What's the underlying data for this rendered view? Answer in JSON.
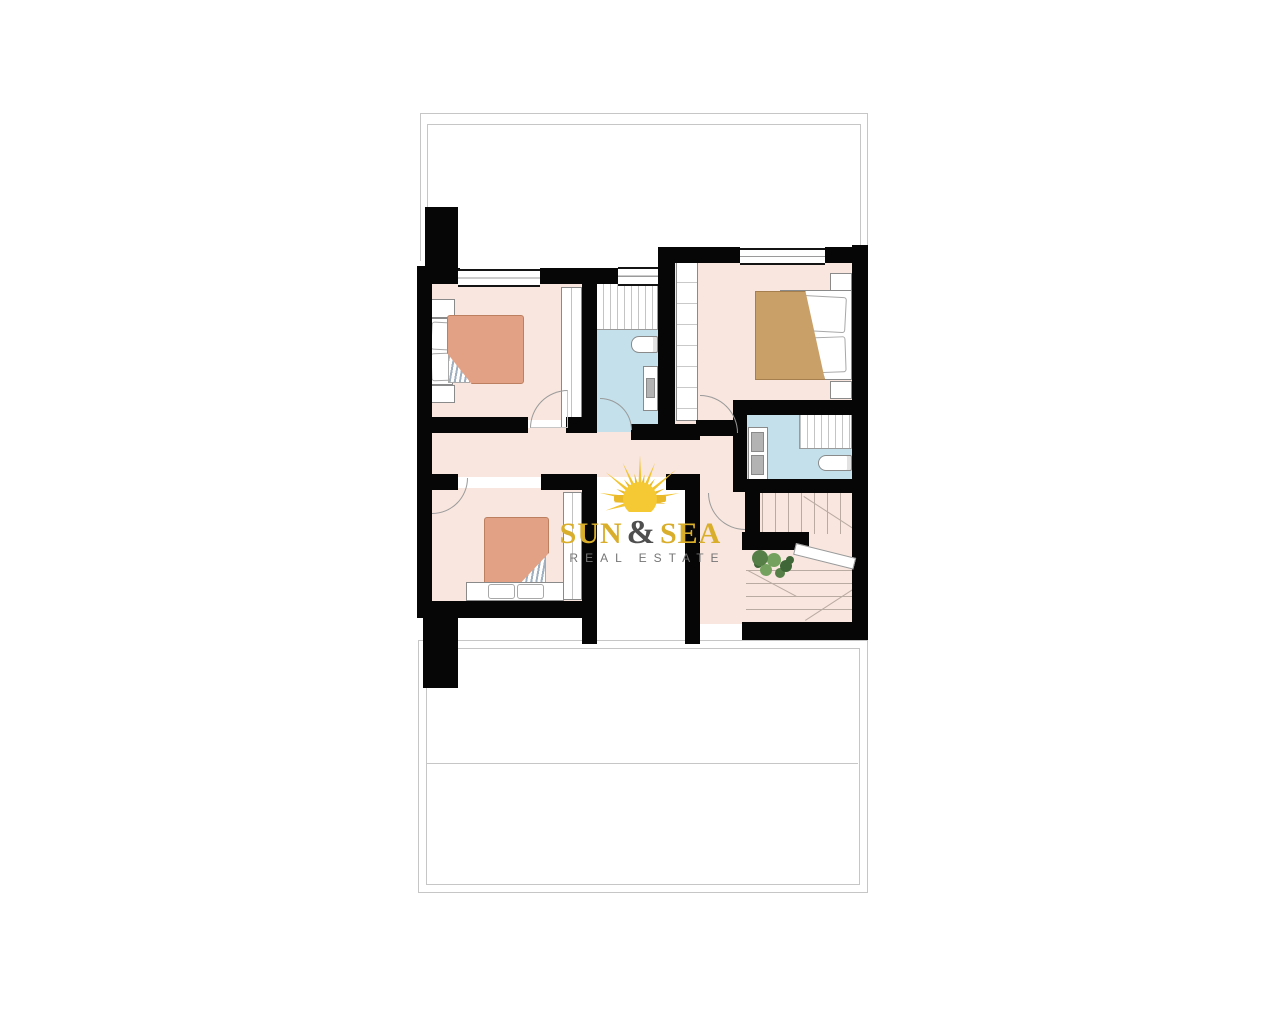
{
  "watermark": {
    "brand": {
      "word1": "SUN",
      "ampersand": "&",
      "word2": "SEA"
    },
    "tagline": "REAL ESTATE"
  },
  "colors": {
    "canvas": "#ffffff",
    "wall": "#060606",
    "floor-pink": "#f8e6df",
    "floor-blue": "#c3e0eb",
    "bed-salmon": "#e2a184",
    "bed-salmon-edge": "#bc8061",
    "bed-tan": "#c9a068",
    "bed-tan-edge": "#a67f4e",
    "furniture-border": "#8a8a8a",
    "line": "#9a9a9a",
    "terrace-line": "#c6c6c6",
    "tread-line": "#b9aaa2",
    "sink-gray": "#b3b3b3",
    "plant-dark": "#3f6636",
    "plant-mid": "#557f47",
    "plant-light": "#74a25e",
    "sun-gold": "#f2c431",
    "sun-gold-dark": "#e9b92a",
    "brand-gold": "#d9ae2b",
    "brand-amp": "#4f4f4f",
    "tagline-gray": "#757575"
  }
}
